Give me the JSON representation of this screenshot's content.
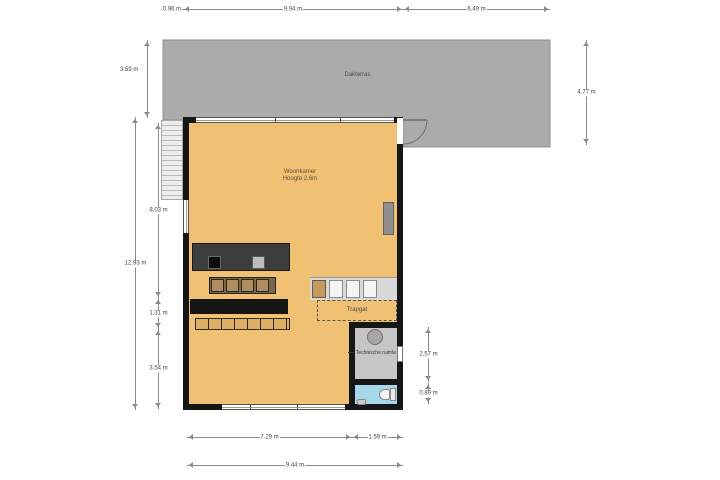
{
  "plan": {
    "rooms": {
      "terrace_label": "Dakterras",
      "living_room_label": "Woonkamer",
      "living_room_height": "Hoogte 2.6m",
      "stairwell_label": "Trapgat",
      "technical_room_label": "Technische ruimte"
    },
    "dimensions": {
      "top": [
        "0.96 m",
        "9.94 m",
        "6.49 m"
      ],
      "left_terrace": "3.59 m",
      "left_total": "12.93 m",
      "left_inner": [
        "8.03 m",
        "1.31 m",
        "3.54 m"
      ],
      "right_terrace": "4.77 m",
      "right_technical_room": "2.57 m",
      "right_toilet": "0.89 m",
      "bottom_segments": [
        "7.29 m",
        "1.59 m"
      ],
      "bottom_total": "9.44 m"
    },
    "colors": {
      "floor": "#f0c173",
      "terrace": "#ababab",
      "wall": "#161616",
      "counter": "#3d3d3d",
      "cabinet": "#b28c5c",
      "stair_tread": "#f4f4f4",
      "technical_room_floor": "#c6c6c6",
      "toilet_floor": "#a5d8ea"
    }
  }
}
